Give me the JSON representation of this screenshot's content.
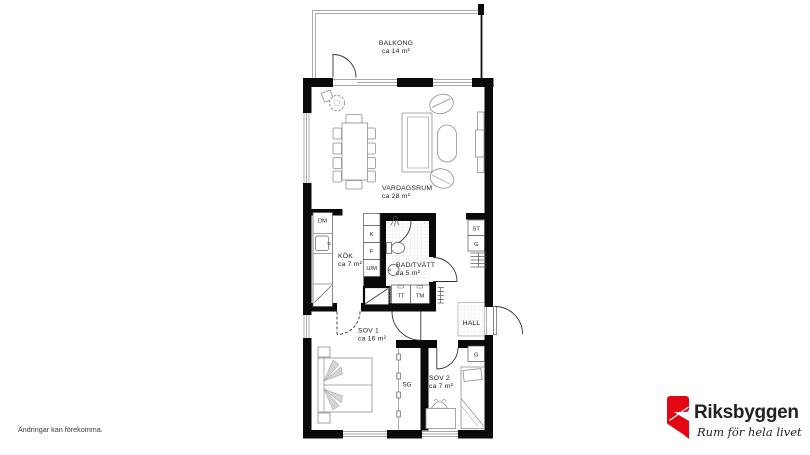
{
  "plan": {
    "rooms": {
      "balkong": {
        "name": "BALKONG",
        "area": "ca 14 m²"
      },
      "vardagsrum": {
        "name": "VARDAGSRUM",
        "area": "ca 28 m²"
      },
      "kok": {
        "name": "KÖK",
        "area": "ca 7 m²"
      },
      "bad_tvatt": {
        "name": "BAD/TVÄTT",
        "area": "ca 5 m²"
      },
      "sov1": {
        "name": "SOV 1",
        "area": "ca 16 m²"
      },
      "sov2": {
        "name": "SOV 2",
        "area": "ca 7 m²"
      },
      "hall": {
        "name": "HALL"
      }
    },
    "fixtures": {
      "dishwasher": "DM",
      "fridge": "K",
      "freezer": "F",
      "oven_micro": "U/M",
      "dryer": "TT",
      "washer": "TM",
      "cleaning_closet": "ST",
      "wardrobe_hall": "G",
      "wardrobe_sov2": "G",
      "sliding_wardrobe": "SG"
    }
  },
  "footer": {
    "disclaimer": "Ändringar kan förekomma."
  },
  "logo": {
    "brand": "Riksbyggen",
    "tagline": "Rum för hela livet",
    "brand_color": "#E30613",
    "text_color": "#9D9D9C",
    "tagline_color": "#3D3D3B"
  }
}
